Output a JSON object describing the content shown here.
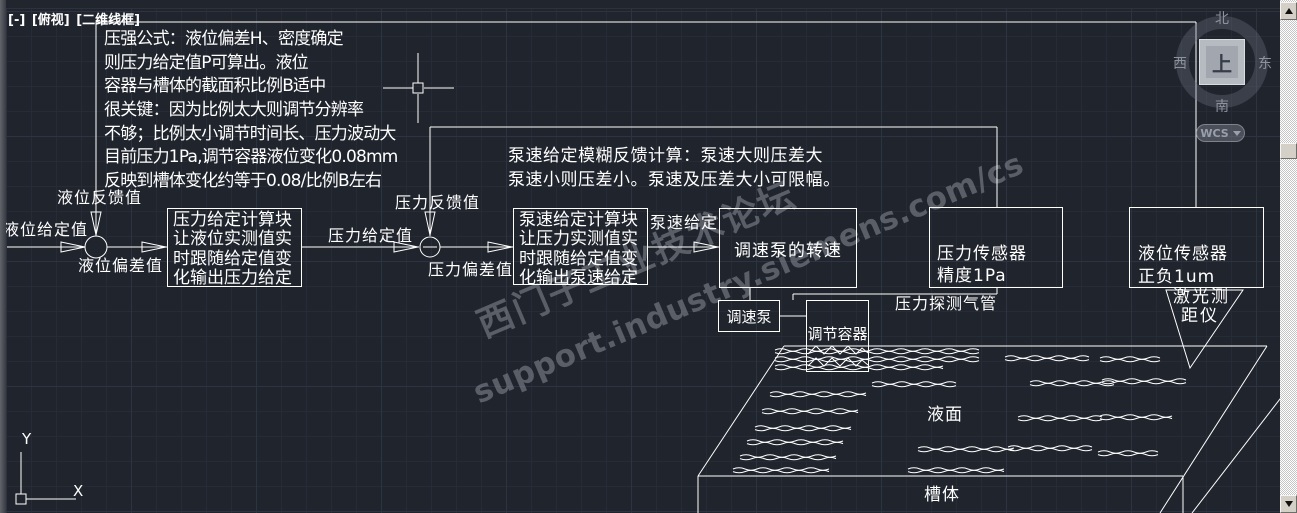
{
  "viewport_controls": {
    "collapse": "[-]",
    "view_name": "[俯视]",
    "visual_style": "[二维线框]"
  },
  "note_block": {
    "lines": [
      "压强公式：液位偏差H、密度确定",
      "则压力给定值P可算出。液位",
      "容器与槽体的截面积比例B适中",
      "很关键：因为比例太大则调节分辨率",
      "不够；比例太小调节时间长、压力波动大",
      "目前压力1Pa,调节容器液位变化0.08mm",
      "反映到槽体变化约等于0.08/比例B左右"
    ]
  },
  "pump_note": {
    "lines": [
      "泵速给定模糊反馈计算：泵速大则压差大",
      "泵速小则压差小。泵速及压差大小可限幅。"
    ]
  },
  "labels": {
    "level_setpoint": "液位给定值",
    "level_feedback": "液位反馈值",
    "level_error": "液位偏差值",
    "pressure_setpoint": "压力给定值",
    "pressure_feedback": "压力反馈值",
    "pressure_error": "压力偏差值",
    "pump_speed_setpoint": "泵速给定",
    "pressure_pipe": "压力探测气管",
    "laser_line1": "激光测",
    "laser_line2": "距仪",
    "liquid_surface": "液面",
    "tank": "槽体"
  },
  "blocks": {
    "pressure_calc": {
      "lines": [
        "压力给定计算块",
        "让液位实测值实",
        "时跟随给定值变",
        "化输出压力给定"
      ]
    },
    "pump_calc": {
      "lines": [
        "泵速给定计算块",
        "让压力实测值实",
        "时跟随给定值变",
        "化输出泵速给定"
      ]
    },
    "pump_speed": {
      "label": "调速泵的转速"
    },
    "pressure_sensor": {
      "line1": "压力传感器",
      "line2": "精度1Pa"
    },
    "level_sensor": {
      "line1": "液位传感器",
      "line2": "正负1um"
    },
    "pump": {
      "label": "调速泵"
    },
    "container": {
      "label": "调节容器"
    }
  },
  "watermark": {
    "line1": "西门子工业技术论坛",
    "line2": "support.industry.siemens.com/cs"
  },
  "viewcube": {
    "north": "北",
    "south": "南",
    "west": "西",
    "east": "东",
    "top_face": "上"
  },
  "wcs": {
    "label": "WCS"
  },
  "ucs_icon": {
    "x_label": "X",
    "y_label": "Y"
  },
  "colors": {
    "canvas_bg": "#20242d",
    "line": "#ffffff",
    "grid_minor": "#262b36",
    "grid_major": "#2d3340",
    "watermark": "#9298a2",
    "scrollbar_face": "#d4d0c8"
  }
}
